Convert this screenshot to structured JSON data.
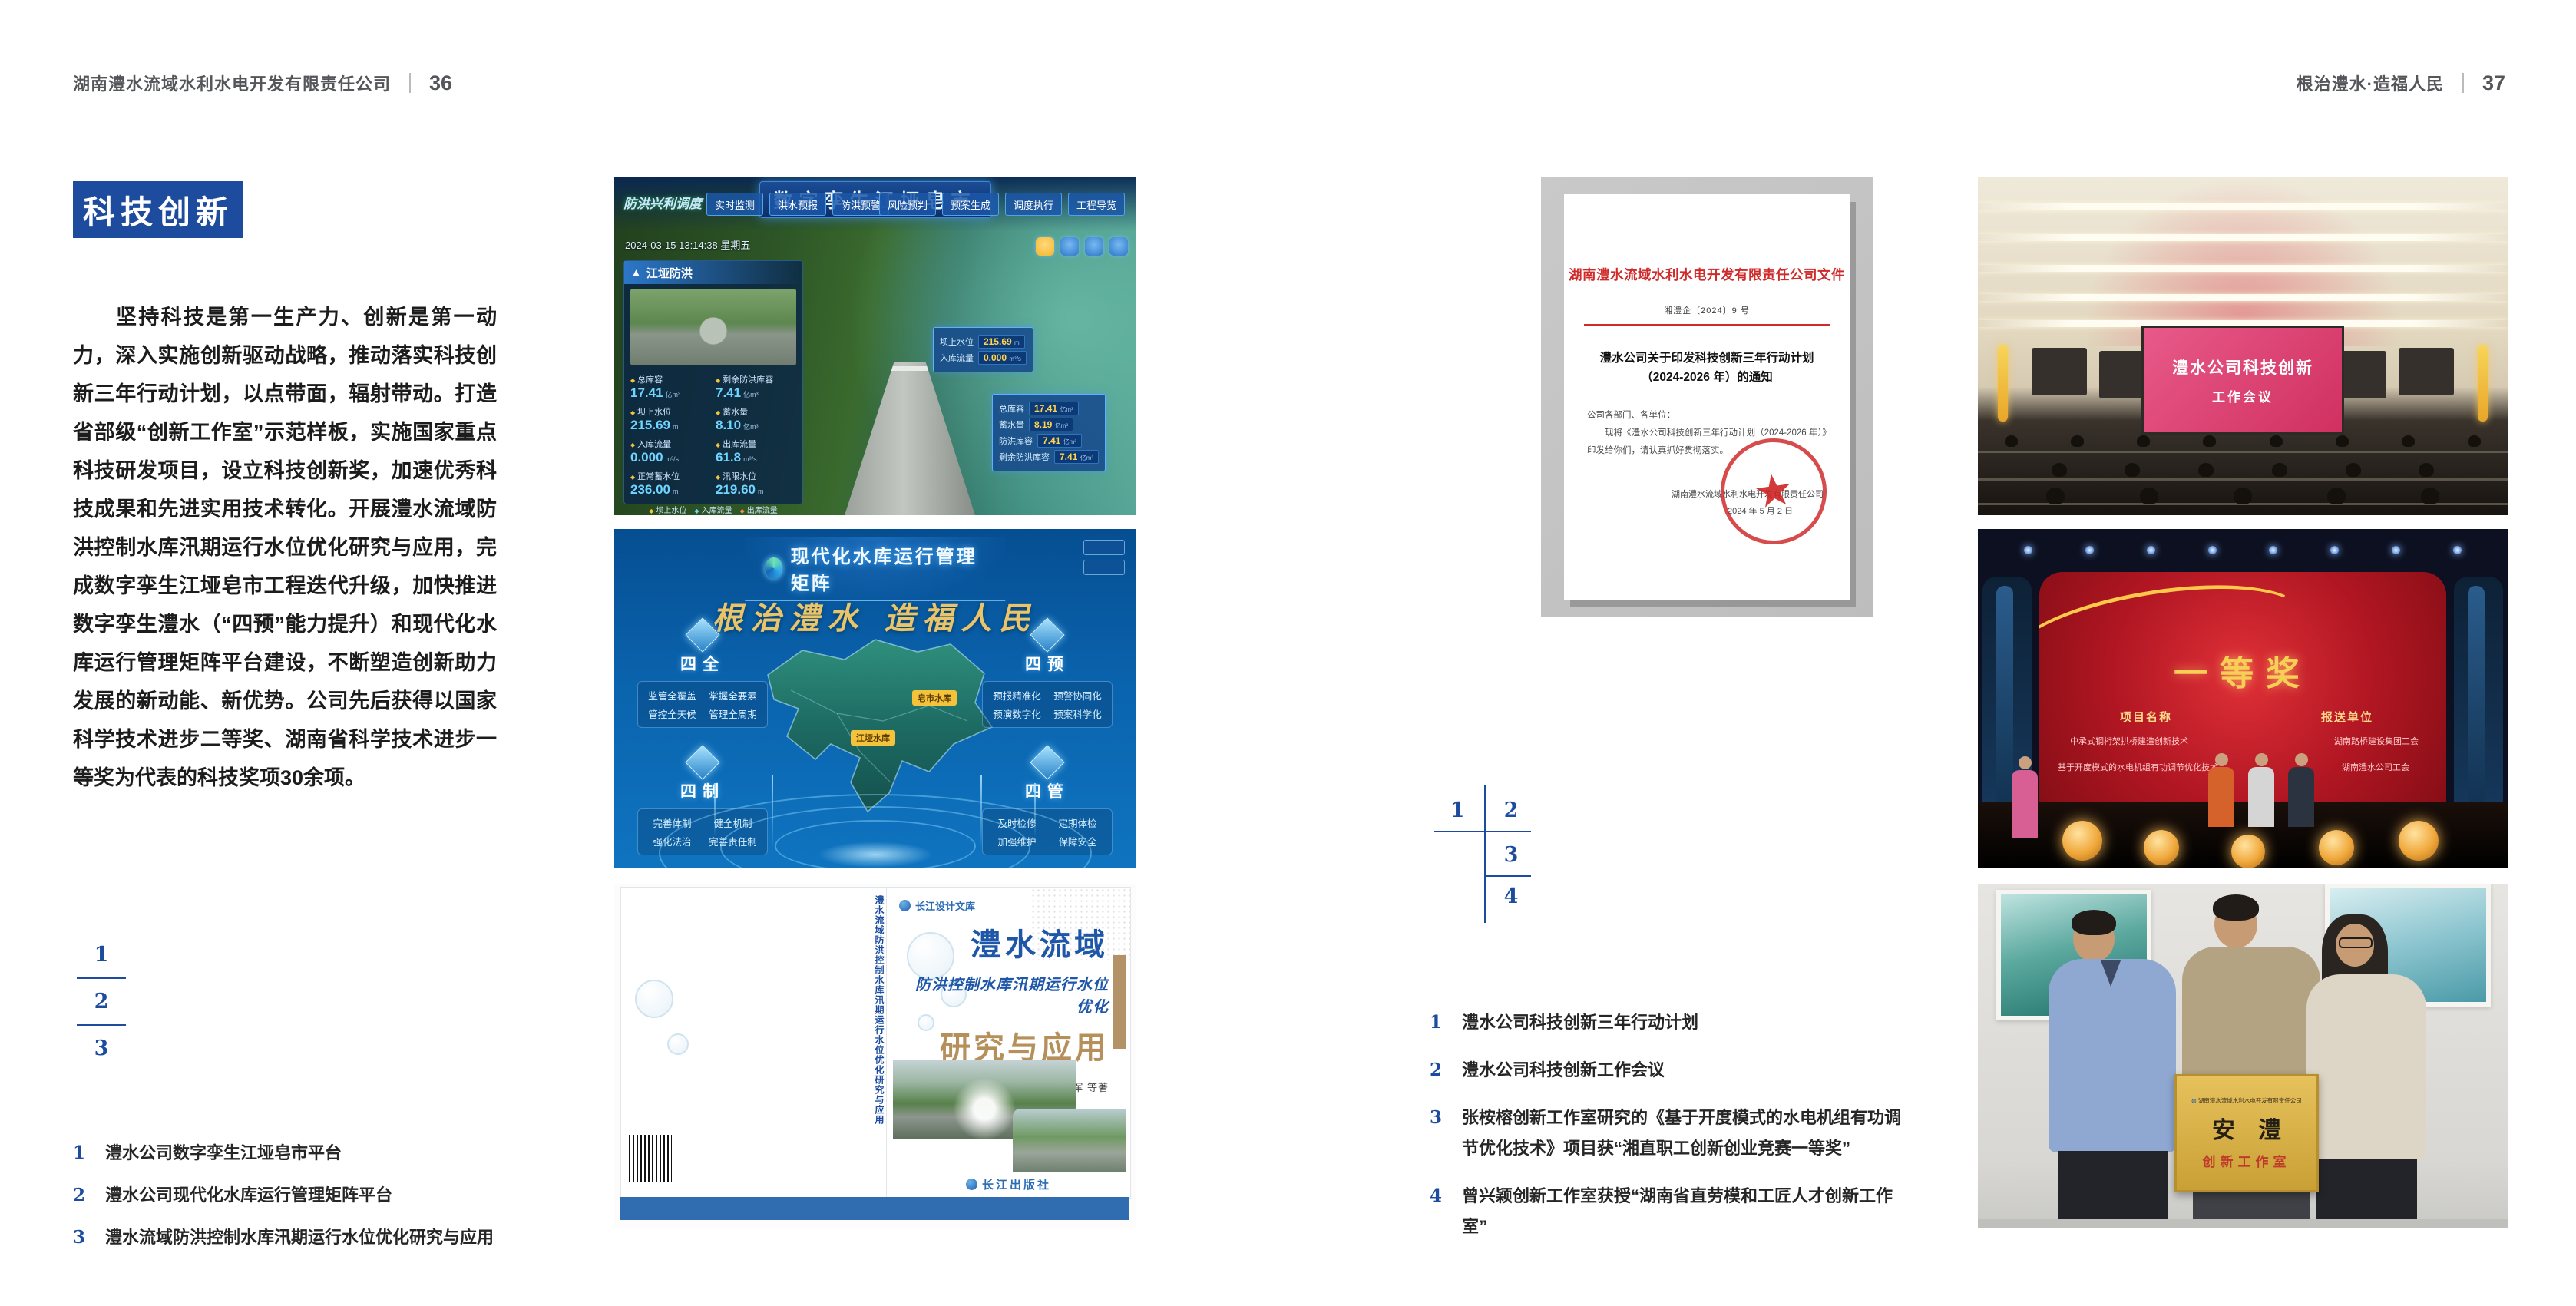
{
  "header": {
    "left_title": "湖南澧水流域水利水电开发有限责任公司",
    "left_page": "36",
    "right_title": "根治澧水·造福人民",
    "right_page": "37"
  },
  "left_page": {
    "badge": "科技创新",
    "paragraph": "坚持科技是第一生产力、创新是第一动力，深入实施创新驱动战略，推动落实科技创新三年行动计划，以点带面，辐射带动。打造省部级“创新工作室”示范样板，实施国家重点科技研发项目，设立科技创新奖，加速优秀科技成果和先进实用技术转化。开展澧水流域防洪控制水库汛期运行水位优化研究与应用，完成数字孪生江垭皂市工程迭代升级，加快推进数字孪生澧水（“四预”能力提升）和现代化水库运行管理矩阵平台建设，不断塑造创新助力发展的新动能、新优势。公司先后获得以国家科学技术进步二等奖、湖南省科学技术进步一等奖为代表的科技奖项30余项。",
    "fig_nums": [
      "1",
      "2",
      "3"
    ],
    "captions": [
      {
        "num": "1",
        "text": "澧水公司数字孪生江垭皂市平台"
      },
      {
        "num": "2",
        "text": "澧水公司现代化水库运行管理矩阵平台"
      },
      {
        "num": "3",
        "text": "澧水流域防洪控制水库汛期运行水位优化研究与应用"
      }
    ]
  },
  "right_page": {
    "fig_nums": [
      "1",
      "2",
      "3",
      "4"
    ],
    "captions": [
      {
        "num": "1",
        "text": "澧水公司科技创新三年行动计划"
      },
      {
        "num": "2",
        "text": "澧水公司科技创新工作会议"
      },
      {
        "num": "3",
        "text": "张桉榕创新工作室研究的《基于开度模式的水电机组有功调节优化技术》项目获“湘直职工创新创业竞赛一等奖”"
      },
      {
        "num": "4",
        "text": "曾兴颖创新工作室获授“湖南省直劳模和工匠人才创新工作室”"
      }
    ]
  },
  "figures": {
    "dashboard": {
      "title": "数字孪生江垭皂市",
      "corner_label": "防洪兴利调度",
      "tabs_left": [
        "实时监测",
        "洪水预报",
        "防洪预警"
      ],
      "tabs_right": [
        "风险预判",
        "预案生成",
        "调度执行",
        "工程导览"
      ],
      "timestamp": "2024-03-15 13:14:38 星期五",
      "panel_title": "江垭防洪",
      "stats": [
        {
          "label": "总库容",
          "value": "17.41",
          "unit": "亿m³"
        },
        {
          "label": "剩余防洪库容",
          "value": "7.41",
          "unit": "亿m³"
        },
        {
          "label": "坝上水位",
          "value": "215.69",
          "unit": "m"
        },
        {
          "label": "蓄水量",
          "value": "8.10",
          "unit": "亿m³"
        },
        {
          "label": "入库流量",
          "value": "0.000",
          "unit": "m³/s"
        },
        {
          "label": "出库流量",
          "value": "61.8",
          "unit": "m³/s"
        },
        {
          "label": "正常蓄水位",
          "value": "236.00",
          "unit": "m"
        },
        {
          "label": "汛限水位",
          "value": "219.60",
          "unit": "m"
        }
      ],
      "legend": [
        "坝上水位",
        "入库流量",
        "出库流量"
      ],
      "tooltip": [
        {
          "label": "坝上水位",
          "value": "215.69",
          "unit": "m"
        },
        {
          "label": "入库流量",
          "value": "0.000",
          "unit": "m³/s"
        }
      ],
      "info": [
        {
          "label": "总库容",
          "value": "17.41",
          "unit": "亿m³"
        },
        {
          "label": "蓄水量",
          "value": "8.19",
          "unit": "亿m³"
        },
        {
          "label": "防洪库容",
          "value": "7.41",
          "unit": "亿m³"
        },
        {
          "label": "剩余防洪库容",
          "value": "7.41",
          "unit": "亿m³"
        }
      ]
    },
    "matrix": {
      "title": "现代化水库运行管理矩阵",
      "slogan": "根治澧水 造福人民",
      "groups": [
        {
          "name": "四全",
          "items": [
            "监管全覆盖",
            "掌握全要素",
            "管控全天候",
            "管理全周期"
          ]
        },
        {
          "name": "四预",
          "items": [
            "预报精准化",
            "预警协同化",
            "预演数字化",
            "预案科学化"
          ]
        },
        {
          "name": "四制",
          "items": [
            "完善体制",
            "健全机制",
            "强化法治",
            "完善责任制"
          ]
        },
        {
          "name": "四管",
          "items": [
            "及时检修",
            "定期体检",
            "加强维护",
            "保障安全"
          ]
        }
      ],
      "markers": [
        "皂市水库",
        "江垭水库"
      ]
    },
    "book": {
      "series": "长江设计文库",
      "title1": "澧水流域",
      "title2": "防洪控制水库汛期运行水位优化",
      "title3": "研究与应用",
      "authors": "洪兴骏  沈坤民  鲁军  刘世军  等著",
      "publisher": "长江出版社",
      "spine_title": "澧水流域防洪控制水库汛期运行水位优化研究与应用"
    },
    "document": {
      "header": "湖南澧水流域水利水电开发有限责任公司文件",
      "doc_no": "湘澧企〔2024〕9 号",
      "subject_line1": "澧水公司关于印发科技创新三年行动计划",
      "subject_line2": "（2024-2026 年）的通知",
      "salutation": "公司各部门、各单位：",
      "body": "　　现将《澧水公司科技创新三年行动计划（2024-2026 年）》印发给你们，请认真抓好贯彻落实。",
      "signer": "湖南澧水流域水利水电开发有限责任公司",
      "date": "2024 年 5 月 2 日"
    },
    "meeting": {
      "screen_line1": "澧水公司科技创新",
      "screen_line2": "工作会议"
    },
    "award": {
      "title": "一等奖",
      "col1": "项目名称",
      "col2": "报送单位",
      "rows": [
        {
          "project": "中承式钢桁架拱桥建造创新技术",
          "unit": "湖南路桥建设集团工会"
        },
        {
          "project": "基于开度模式的水电机组有功调节优化技术",
          "unit": "湖南澧水公司工会"
        }
      ]
    },
    "group": {
      "plaque_org": "湖南澧水流域水利水电开发有限责任公司",
      "plaque_main": "安澧",
      "plaque_sub": "创新工作室"
    }
  }
}
